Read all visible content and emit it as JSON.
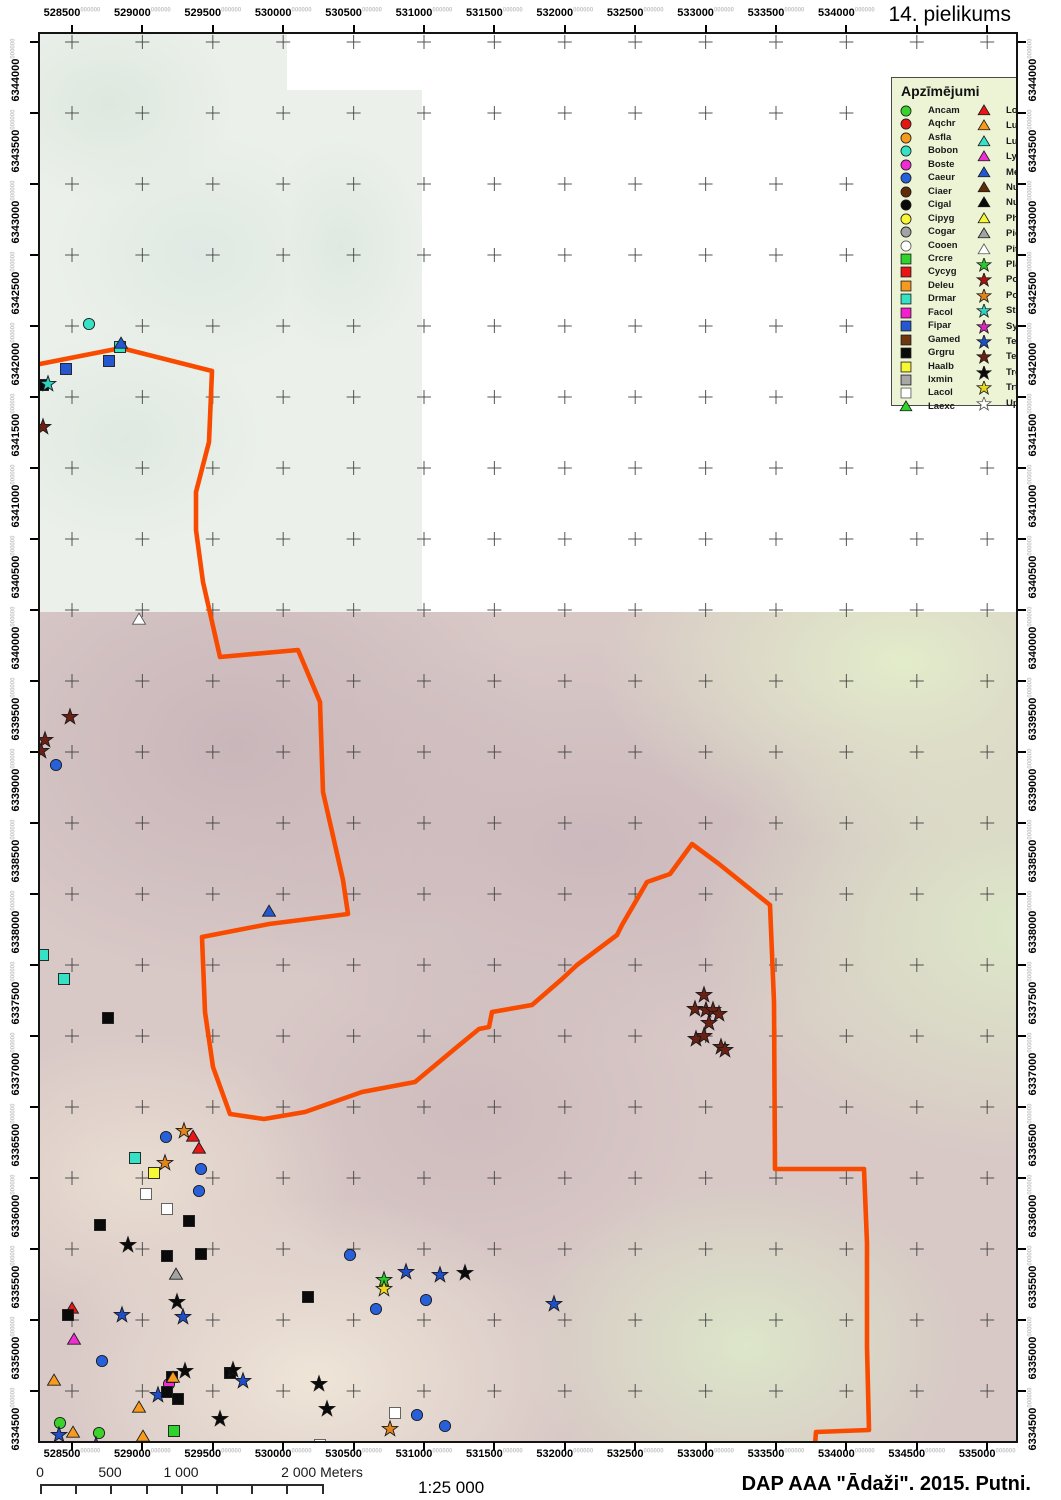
{
  "title": "14. pielikums",
  "footer": {
    "ratio": "1:25 000",
    "credit": "DAP AAA \"Ādaži\". 2015. Putni.",
    "scalebar_labels": [
      {
        "text": "0",
        "meters": 0
      },
      {
        "text": "500",
        "meters": 500
      },
      {
        "text": "1 000",
        "meters": 1000
      },
      {
        "text": "2 000 Meters",
        "meters": 2000
      }
    ]
  },
  "grid": {
    "superscript": "000000",
    "x_labels_top": [
      "528500",
      "529000",
      "529500",
      "530000",
      "530500",
      "531000",
      "531500",
      "532000",
      "532500",
      "533000",
      "533500",
      "534000"
    ],
    "x_labels_bottom": [
      "528500",
      "529000",
      "529500",
      "530000",
      "530500",
      "531000",
      "531500",
      "532000",
      "532500",
      "533000",
      "533500",
      "534000",
      "534500",
      "535000"
    ],
    "y_labels": [
      "6344000",
      "6343500",
      "6343000",
      "6342500",
      "6342000",
      "6341500",
      "6341000",
      "6340500",
      "6340000",
      "6339500",
      "6339000",
      "6338500",
      "6338000",
      "6337500",
      "6337000",
      "6336500",
      "6336000",
      "6335500",
      "6335000",
      "6334500"
    ]
  },
  "legend": {
    "title": "Apzīmējumi",
    "background": "#edf4d6",
    "col1": [
      {
        "code": "Ancam",
        "shape": "circle",
        "color": "#3bd32b"
      },
      {
        "code": "Aqchr",
        "shape": "circle",
        "color": "#e31616"
      },
      {
        "code": "Asfla",
        "shape": "circle",
        "color": "#f79b1e"
      },
      {
        "code": "Bobon",
        "shape": "circle",
        "color": "#35e2c6"
      },
      {
        "code": "Boste",
        "shape": "circle",
        "color": "#ee2ed2"
      },
      {
        "code": "Caeur",
        "shape": "circle",
        "color": "#2760d8"
      },
      {
        "code": "Ciaer",
        "shape": "circle",
        "color": "#5f2c05"
      },
      {
        "code": "Cigal",
        "shape": "circle",
        "color": "#0a0a0a"
      },
      {
        "code": "Cipyg",
        "shape": "circle",
        "color": "#f7f733"
      },
      {
        "code": "Cogar",
        "shape": "circle",
        "color": "#a3a3a3"
      },
      {
        "code": "Cooen",
        "shape": "circle",
        "color": "#ffffff"
      },
      {
        "code": "Crcre",
        "shape": "square",
        "color": "#2ed32e"
      },
      {
        "code": "Cycyg",
        "shape": "square",
        "color": "#e81616"
      },
      {
        "code": "Deleu",
        "shape": "square",
        "color": "#f79b1e"
      },
      {
        "code": "Drmar",
        "shape": "square",
        "color": "#35e2c6"
      },
      {
        "code": "Facol",
        "shape": "square",
        "color": "#f51fd2"
      },
      {
        "code": "Fipar",
        "shape": "square",
        "color": "#2558d0"
      },
      {
        "code": "Gamed",
        "shape": "square",
        "color": "#703810"
      },
      {
        "code": "Grgru",
        "shape": "square",
        "color": "#0a0a0a"
      },
      {
        "code": "Haalb",
        "shape": "square",
        "color": "#f7f733"
      },
      {
        "code": "Ixmin",
        "shape": "square",
        "color": "#a8a8a8"
      },
      {
        "code": "Lacol",
        "shape": "square",
        "color": "#ffffff"
      },
      {
        "code": "Laexc",
        "shape": "triangle",
        "color": "#2ed32e"
      }
    ],
    "col2": [
      {
        "code": "Lolus",
        "shape": "triangle",
        "color": "#e81616"
      },
      {
        "code": "Luarb",
        "shape": "triangle",
        "color": "#f79b1e"
      },
      {
        "code": "Lusve",
        "shape": "triangle",
        "color": "#35e2c6"
      },
      {
        "code": "Lymin",
        "shape": "triangle",
        "color": "#ee2ed2"
      },
      {
        "code": "Memer",
        "shape": "triangle",
        "color": "#2558d0"
      },
      {
        "code": "Nuarq",
        "shape": "triangle",
        "color": "#5f2c05"
      },
      {
        "code": "Nupha",
        "shape": "triangle",
        "color": "#0a0a0a"
      },
      {
        "code": "Phpug",
        "shape": "triangle",
        "color": "#f7f733"
      },
      {
        "code": "Pican",
        "shape": "triangle",
        "color": "#a3a3a3"
      },
      {
        "code": "Pitri",
        "shape": "triangle",
        "color": "#ffffff"
      },
      {
        "code": "Plapr",
        "shape": "star",
        "color": "#2ec82e"
      },
      {
        "code": "Popar",
        "shape": "star",
        "color": "#a81410"
      },
      {
        "code": "Popor",
        "shape": "star",
        "color": "#e2841c"
      },
      {
        "code": "Stura",
        "shape": "star",
        "color": "#2fd2c0"
      },
      {
        "code": "Synis",
        "shape": "star",
        "color": "#d627b8"
      },
      {
        "code": "Tetet",
        "shape": "star",
        "color": "#1f4ec6"
      },
      {
        "code": "Teuro",
        "shape": "star",
        "color": "#6b2014"
      },
      {
        "code": "Trgla",
        "shape": "star",
        "color": "#0a0a0a"
      },
      {
        "code": "Trtot",
        "shape": "star",
        "color": "#ead81f"
      },
      {
        "code": "Upepo",
        "shape": "star",
        "color": "#ffffff"
      }
    ]
  },
  "boundary": {
    "color": "#f84b00",
    "points": [
      [
        0,
        330
      ],
      [
        81,
        314
      ],
      [
        172,
        337
      ],
      [
        169,
        408
      ],
      [
        156,
        458
      ],
      [
        156,
        496
      ],
      [
        163,
        548
      ],
      [
        180,
        623
      ],
      [
        258,
        616
      ],
      [
        280,
        668
      ],
      [
        283,
        758
      ],
      [
        303,
        846
      ],
      [
        308,
        880
      ],
      [
        229,
        890
      ],
      [
        162,
        903
      ],
      [
        165,
        978
      ],
      [
        173,
        1033
      ],
      [
        190,
        1080
      ],
      [
        224,
        1085
      ],
      [
        265,
        1078
      ],
      [
        322,
        1058
      ],
      [
        375,
        1048
      ],
      [
        417,
        1013
      ],
      [
        439,
        995
      ],
      [
        449,
        993
      ],
      [
        452,
        978
      ],
      [
        492,
        971
      ],
      [
        522,
        945
      ],
      [
        537,
        931
      ],
      [
        577,
        901
      ],
      [
        582,
        891
      ],
      [
        607,
        848
      ],
      [
        630,
        840
      ],
      [
        652,
        810
      ],
      [
        679,
        830
      ],
      [
        730,
        871
      ],
      [
        734,
        968
      ],
      [
        735,
        1135
      ],
      [
        824,
        1135
      ],
      [
        827,
        1209
      ],
      [
        827,
        1313
      ],
      [
        829,
        1396
      ],
      [
        776,
        1398
      ],
      [
        775,
        1411
      ]
    ]
  },
  "markers": [
    [
      "Bobon",
      49,
      290
    ],
    [
      "Drmar",
      80,
      313
    ],
    [
      "Memer",
      81,
      310
    ],
    [
      "Fipar",
      26,
      335
    ],
    [
      "Fipar",
      69,
      327
    ],
    [
      "Grgru",
      3,
      351
    ],
    [
      "Stura",
      8,
      350
    ],
    [
      "Teuro",
      3,
      393
    ],
    [
      "Pitri",
      99,
      586
    ],
    [
      "Teuro",
      30,
      683
    ],
    [
      "Teuro",
      5,
      706
    ],
    [
      "Teuro",
      1,
      717
    ],
    [
      "Caeur",
      16,
      731
    ],
    [
      "Memer",
      229,
      878
    ],
    [
      "Drmar",
      3,
      921
    ],
    [
      "Drmar",
      24,
      945
    ],
    [
      "Grgru",
      68,
      984
    ],
    [
      "Teuro",
      664,
      961
    ],
    [
      "Teuro",
      655,
      975
    ],
    [
      "Teuro",
      666,
      976
    ],
    [
      "Teuro",
      673,
      976
    ],
    [
      "Teuro",
      679,
      980
    ],
    [
      "Teuro",
      669,
      989
    ],
    [
      "Teuro",
      656,
      1005
    ],
    [
      "Teuro",
      664,
      1002
    ],
    [
      "Teuro",
      681,
      1013
    ],
    [
      "Teuro",
      685,
      1016
    ],
    [
      "Popor",
      144,
      1097
    ],
    [
      "Caeur",
      126,
      1103
    ],
    [
      "Lolus",
      153,
      1103
    ],
    [
      "Lolus",
      159,
      1115
    ],
    [
      "Popor",
      125,
      1129
    ],
    [
      "Drmar",
      95,
      1124
    ],
    [
      "Haalb",
      114,
      1139
    ],
    [
      "Caeur",
      161,
      1135
    ],
    [
      "Lacol",
      106,
      1160
    ],
    [
      "Caeur",
      159,
      1157
    ],
    [
      "Lacol",
      127,
      1175
    ],
    [
      "Grgru",
      60,
      1191
    ],
    [
      "Grgru",
      149,
      1187
    ],
    [
      "Trgla",
      88,
      1211
    ],
    [
      "Grgru",
      127,
      1222
    ],
    [
      "Grgru",
      161,
      1220
    ],
    [
      "Pican",
      136,
      1241
    ],
    [
      "Trgla",
      137,
      1268
    ],
    [
      "Tetet",
      82,
      1281
    ],
    [
      "Tetet",
      143,
      1283
    ],
    [
      "Lolus",
      32,
      1275
    ],
    [
      "Grgru",
      28,
      1281
    ],
    [
      "Grgru",
      268,
      1263
    ],
    [
      "Caeur",
      310,
      1221
    ],
    [
      "Tetet",
      366,
      1238
    ],
    [
      "Tetet",
      400,
      1241
    ],
    [
      "Trgla",
      425,
      1239
    ],
    [
      "Plapr",
      344,
      1246
    ],
    [
      "Trtot",
      344,
      1255
    ],
    [
      "Caeur",
      386,
      1266
    ],
    [
      "Caeur",
      336,
      1275
    ],
    [
      "Tetet",
      514,
      1270
    ],
    [
      "Lymin",
      34,
      1306
    ],
    [
      "Caeur",
      62,
      1327
    ],
    [
      "Luarb",
      14,
      1347
    ],
    [
      "Boste",
      129,
      1350
    ],
    [
      "Grgru",
      132,
      1343
    ],
    [
      "Luarb",
      133,
      1344
    ],
    [
      "Trgla",
      145,
      1337
    ],
    [
      "Grgru",
      190,
      1339
    ],
    [
      "Trgla",
      193,
      1336
    ],
    [
      "Tetet",
      203,
      1347
    ],
    [
      "Tetet",
      118,
      1361
    ],
    [
      "Grgru",
      127,
      1358
    ],
    [
      "Grgru",
      138,
      1365
    ],
    [
      "Luarb",
      99,
      1374
    ],
    [
      "Trgla",
      180,
      1385
    ],
    [
      "Trgla",
      279,
      1350
    ],
    [
      "Trgla",
      287,
      1375
    ],
    [
      "Ancam",
      20,
      1389
    ],
    [
      "Ancam",
      59,
      1399
    ],
    [
      "Luarb",
      33,
      1399
    ],
    [
      "Tetet",
      19,
      1401
    ],
    [
      "Tetet",
      56,
      1411
    ],
    [
      "Crcre",
      134,
      1397
    ],
    [
      "Luarb",
      103,
      1403
    ],
    [
      "Lacol",
      355,
      1379
    ],
    [
      "Caeur",
      377,
      1381
    ],
    [
      "Popor",
      350,
      1395
    ],
    [
      "Caeur",
      405,
      1392
    ],
    [
      "Lacol",
      280,
      1411
    ]
  ]
}
